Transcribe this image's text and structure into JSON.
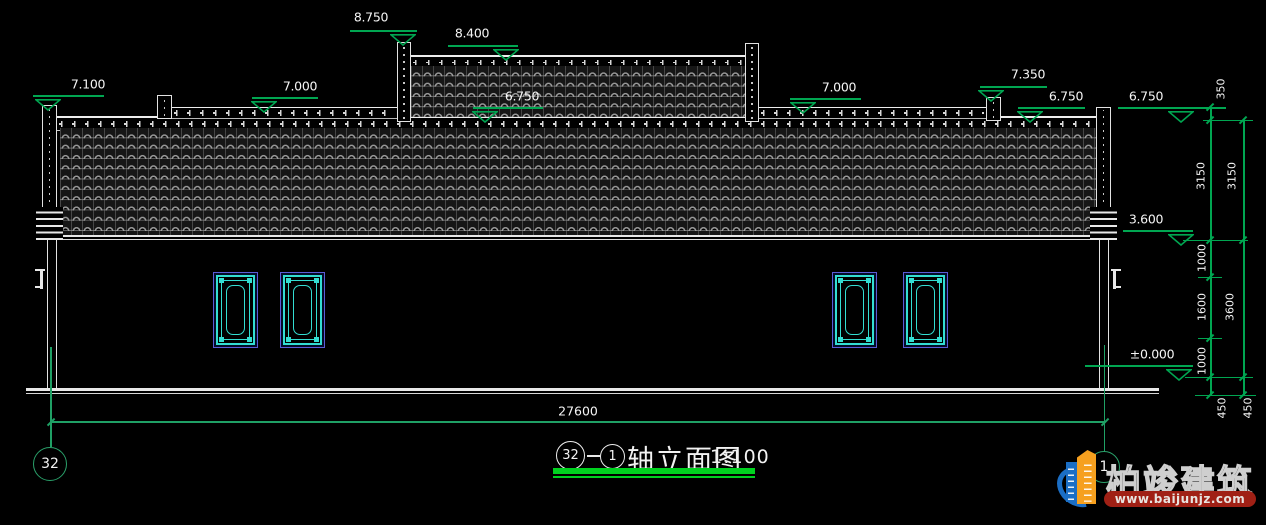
{
  "drawing": {
    "elevation_markers": [
      {
        "id": "clerestory-parapet-top",
        "label": "8.750"
      },
      {
        "id": "clerestory-roof-top",
        "label": "8.400"
      },
      {
        "id": "left-pillar-top",
        "label": "7.100"
      },
      {
        "id": "left-parapet",
        "label": "7.000"
      },
      {
        "id": "main-eave-center",
        "label": "6.750"
      },
      {
        "id": "right-parapet",
        "label": "7.000"
      },
      {
        "id": "right-post-top",
        "label": "7.350"
      },
      {
        "id": "right-eave",
        "label": "6.750"
      },
      {
        "id": "eave-datum-right",
        "label": "6.750"
      },
      {
        "id": "roof-bottom",
        "label": "3.600"
      },
      {
        "id": "floor-level",
        "label": "±0.000"
      }
    ],
    "dimensions": {
      "bottom_total": "27600",
      "right_inner": [
        "350",
        "3150",
        "1000",
        "1600",
        "1000",
        "450"
      ],
      "right_outer": [
        "3150",
        "3600",
        "450"
      ]
    },
    "axis_bubbles": {
      "left": "32",
      "right": "1"
    },
    "title": {
      "axis_start": "32",
      "axis_end": "1",
      "name": "轴立面图",
      "scale": "1:100"
    }
  },
  "watermark": {
    "brand": "柏竣建筑",
    "url": "www.baijunjz.com"
  },
  "colors": {
    "background": "#000000",
    "drawing_white": "#e8e8e8",
    "dimension_green": "#00a651",
    "title_underline_green": "#00d21f",
    "axis_teal": "#1fa065",
    "window_cyan": "#33ddd2",
    "window_frame_border": "#5b5bd6",
    "logo_blue": "#1b6ec5",
    "logo_orange": "#f6a01f",
    "logo_red": "#a02015"
  }
}
